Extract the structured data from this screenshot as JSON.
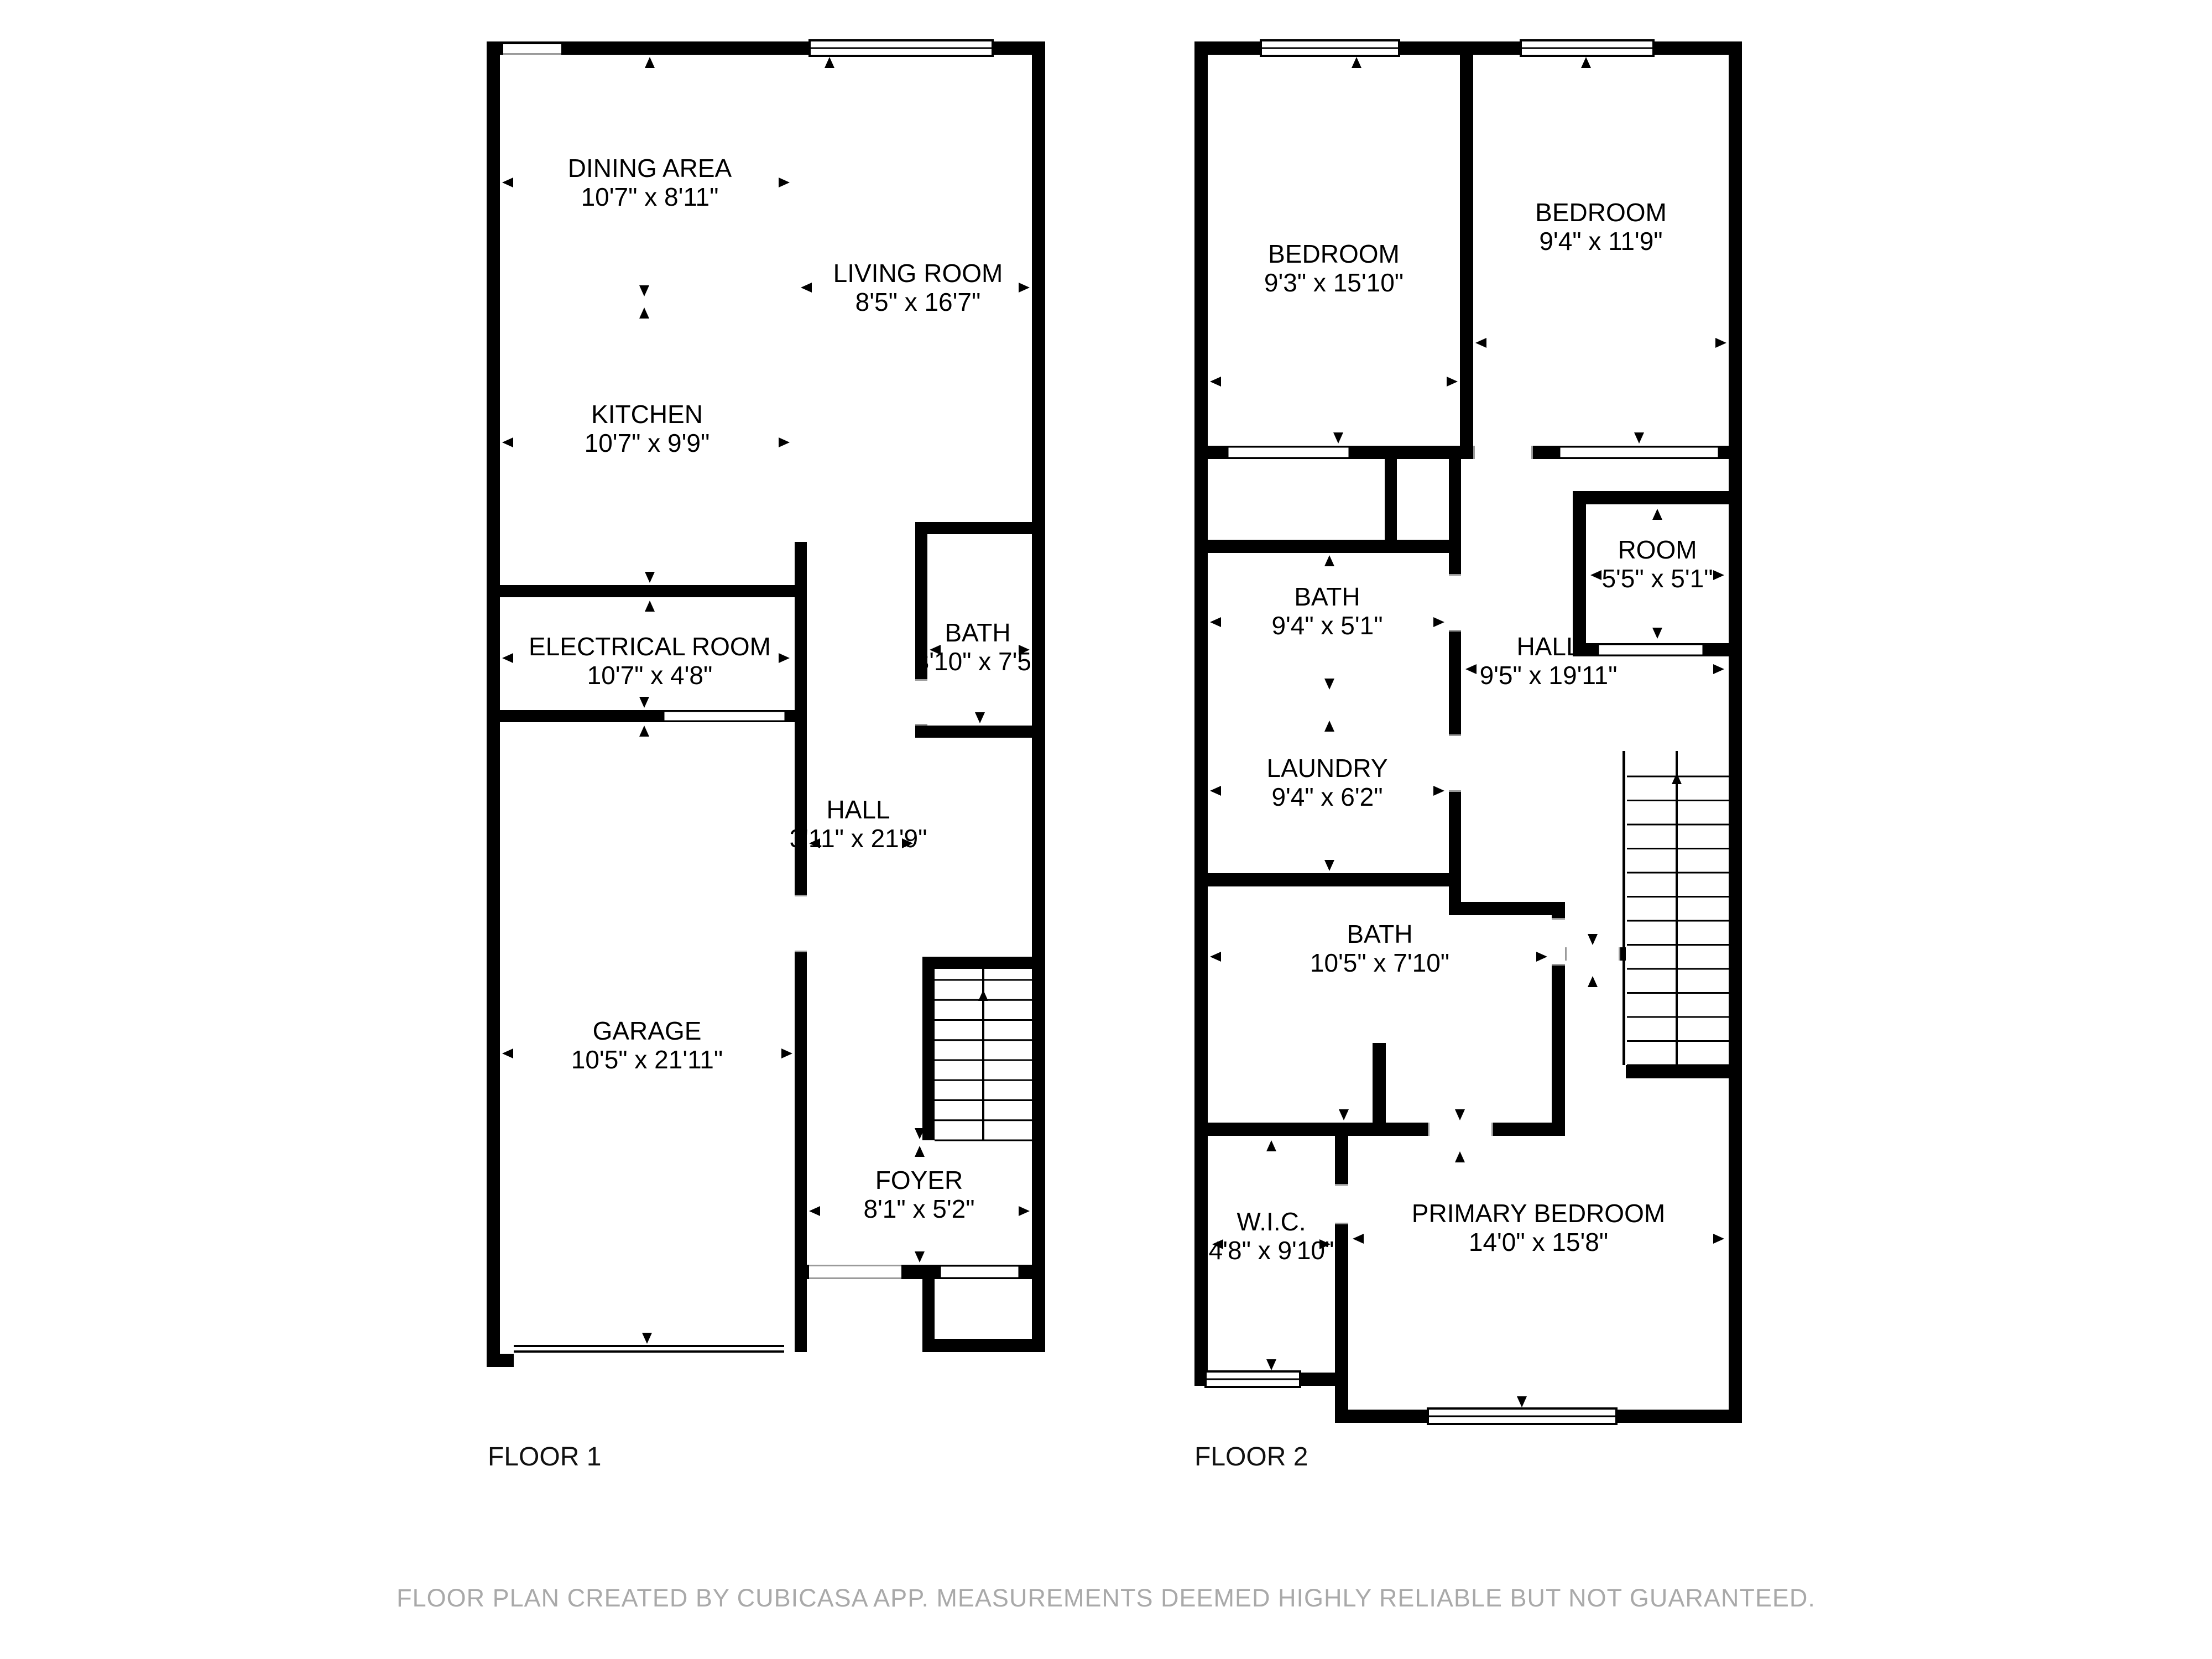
{
  "floor1": {
    "label": "FLOOR 1",
    "rooms": {
      "dining": {
        "name": "DINING AREA",
        "dims": "10'7\" x 8'11\""
      },
      "living": {
        "name": "LIVING ROOM",
        "dims": "8'5\" x 16'7\""
      },
      "kitchen": {
        "name": "KITCHEN",
        "dims": "10'7\" x 9'9\""
      },
      "electrical": {
        "name": "ELECTRICAL ROOM",
        "dims": "10'7\" x 4'8\""
      },
      "bath": {
        "name": "BATH",
        "dims": "3'10\" x 7'5\""
      },
      "hall": {
        "name": "HALL",
        "dims": "3'11\" x 21'9\""
      },
      "garage": {
        "name": "GARAGE",
        "dims": "10'5\" x 21'11\""
      },
      "foyer": {
        "name": "FOYER",
        "dims": "8'1\" x 5'2\""
      }
    }
  },
  "floor2": {
    "label": "FLOOR 2",
    "rooms": {
      "bedroom_left": {
        "name": "BEDROOM",
        "dims": "9'3\" x 15'10\""
      },
      "bedroom_right": {
        "name": "BEDROOM",
        "dims": "9'4\" x 11'9\""
      },
      "bath_upper": {
        "name": "BATH",
        "dims": "9'4\" x 5'1\""
      },
      "room": {
        "name": "ROOM",
        "dims": "5'5\" x 5'1\""
      },
      "hall": {
        "name": "HALL",
        "dims": "9'5\" x 19'11\""
      },
      "laundry": {
        "name": "LAUNDRY",
        "dims": "9'4\" x 6'2\""
      },
      "bath_lower": {
        "name": "BATH",
        "dims": "10'5\" x 7'10\""
      },
      "wic": {
        "name": "W.I.C.",
        "dims": "4'8\" x 9'10\""
      },
      "primary": {
        "name": "PRIMARY BEDROOM",
        "dims": "14'0\" x 15'8\""
      }
    }
  },
  "footer": {
    "disclaimer": "FLOOR PLAN CREATED BY CUBICASA APP. MEASUREMENTS DEEMED HIGHLY RELIABLE BUT NOT GUARANTEED."
  },
  "colors": {
    "wall": "#000000",
    "background": "#ffffff",
    "disclaimer_text": "#a9a9a9"
  }
}
